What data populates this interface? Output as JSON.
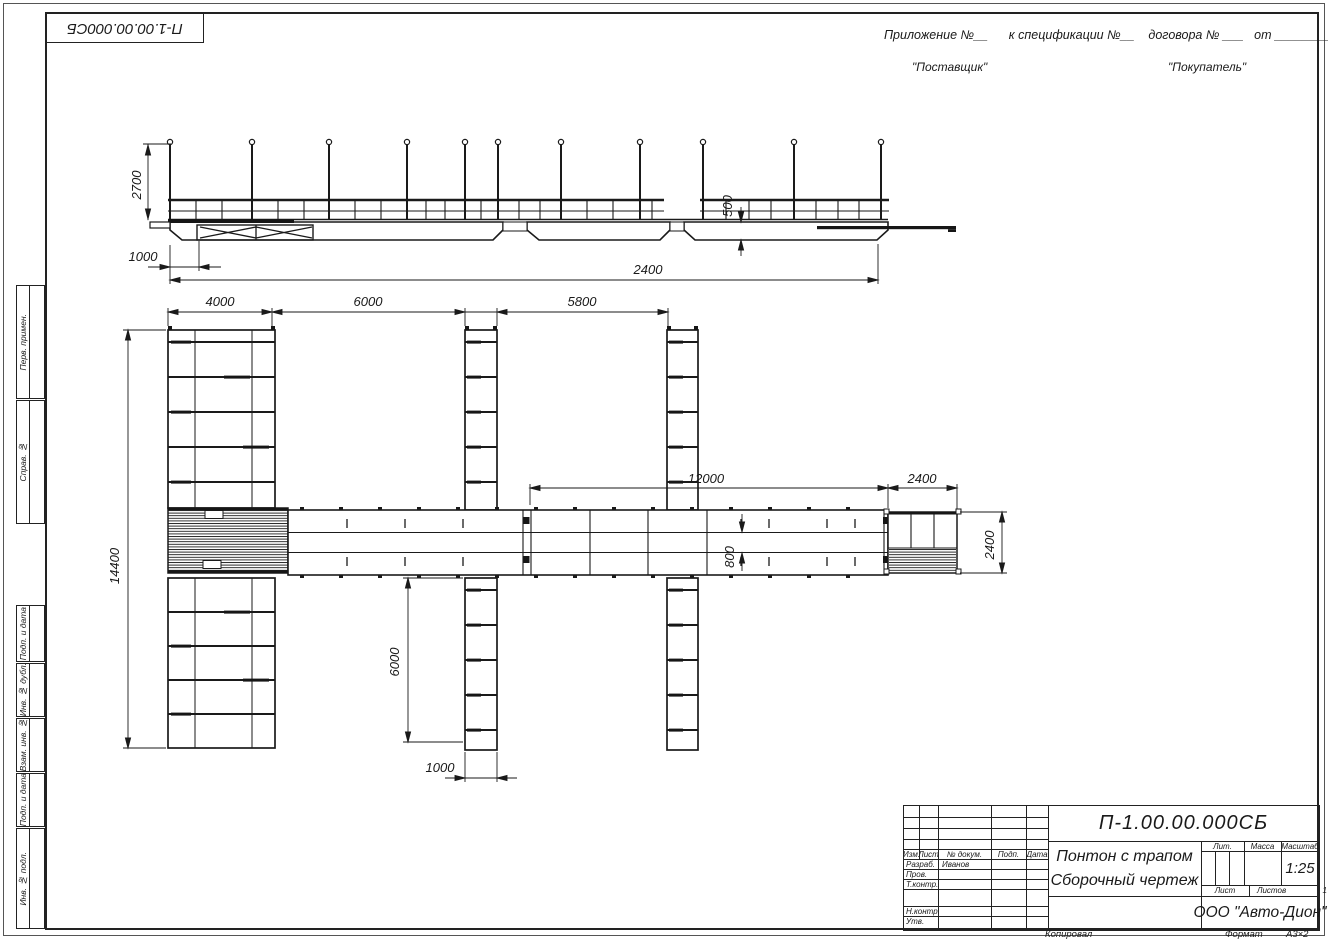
{
  "frame": {
    "doc_number_top": "П-1.00.00.000СБ"
  },
  "appendix": {
    "line": "Приложение №__      к спецификации №__    договора № ___   от _________",
    "supplier": "\"Поставщик\"",
    "buyer": "\"Покупатель\""
  },
  "margin_labels": {
    "perv": "Перв. примен.",
    "sprav": "Справ. №",
    "podp1": "Подп. и дата",
    "inv_dubl": "Инв. № дубл.",
    "vzam": "Взам. инв. №",
    "podp2": "Подп. и дата",
    "inv_podl": "Инв. № подл."
  },
  "titleblock": {
    "doc_number": "П-1.00.00.000СБ",
    "title_line1": "Понтон с трапом",
    "title_line2": "Сборочный чертеж",
    "col_izm": "Изм.",
    "col_list": "Лист",
    "col_doc": "№ докум.",
    "col_podp": "Подп.",
    "col_data": "Дата",
    "row_razrab": "Разраб.",
    "razrab_name": "Иванов",
    "row_prov": "Пров.",
    "row_tkontr": "Т.контр.",
    "row_nkontr": "Н.контр.",
    "row_utv": "Утв.",
    "lit_label": "Лит.",
    "mass_label": "Масса",
    "scale_label": "Масштаб",
    "scale_value": "1:25",
    "sheet_label": "Лист",
    "sheets_label": "Листов",
    "sheets_value": "1",
    "company": "ООО \"Авто-Дион\""
  },
  "footer": {
    "kopiroval": "Копировал",
    "format_label": "Формат",
    "format_value": "А3×2"
  },
  "dims": {
    "side": {
      "height": "2700",
      "offset": "1000",
      "overall": "2400",
      "depth": "500"
    },
    "plan": {
      "pier_width": "4000",
      "bay1": "6000",
      "bay2": "5800",
      "walkway": "12000",
      "ramp_len": "2400",
      "total": "14400",
      "channel": "800",
      "finger_len": "6000",
      "finger_w": "1000",
      "ramp_w": "2400"
    }
  }
}
